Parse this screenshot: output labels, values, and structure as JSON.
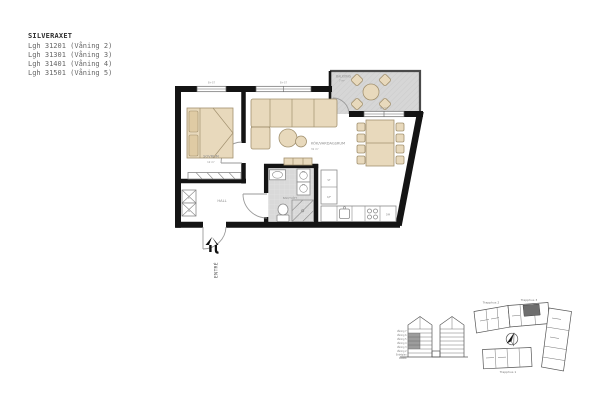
{
  "header": {
    "title": "SILVERAXET",
    "apartments": [
      "Lgh 31201 (Våning 2)",
      "Lgh 31301 (Våning 3)",
      "Lgh 31401 (Våning 4)",
      "Lgh 31501 (Våning 5)"
    ]
  },
  "plan": {
    "bedroom_name": "SOVRUM",
    "bedroom_area": "12 m²",
    "kitchen_living_name": "KÖK/VARDAGSRUM",
    "kitchen_living_area": "31 m²",
    "balcony_name": "BALKONG",
    "balcony_area": "7 m²",
    "bathroom_name": "BAD/TVÄTT",
    "hall_name": "HALL",
    "entrance_label": "ENTRÉ",
    "window_dim": "B+S7",
    "appliances": {
      "tall_cabinet": "ST",
      "fridge_freezer": "K/F",
      "dishwasher": "DM",
      "washing_machine": "TM",
      "dryer": "TT",
      "linen_closet": "L",
      "wardrobe": "G"
    }
  },
  "overview": {
    "elevation_floors": [
      "Våning 7",
      "Våning 6",
      "Våning 5",
      "Våning 4",
      "Våning 3",
      "Våning 2",
      "Entréplan",
      "Källare"
    ],
    "stairwells": {
      "t1": "Trapphus 1",
      "t2": "Trapphus 2",
      "t3": "Trapphus 3"
    }
  },
  "colors": {
    "wall": "#141414",
    "furniture_fill": "#e8d9bc",
    "floor_gray": "#d9d9d9",
    "balcony_gray": "#d6d6d6",
    "unit_highlight": "#6e6e6e",
    "label_gray": "#8a8a8a"
  }
}
